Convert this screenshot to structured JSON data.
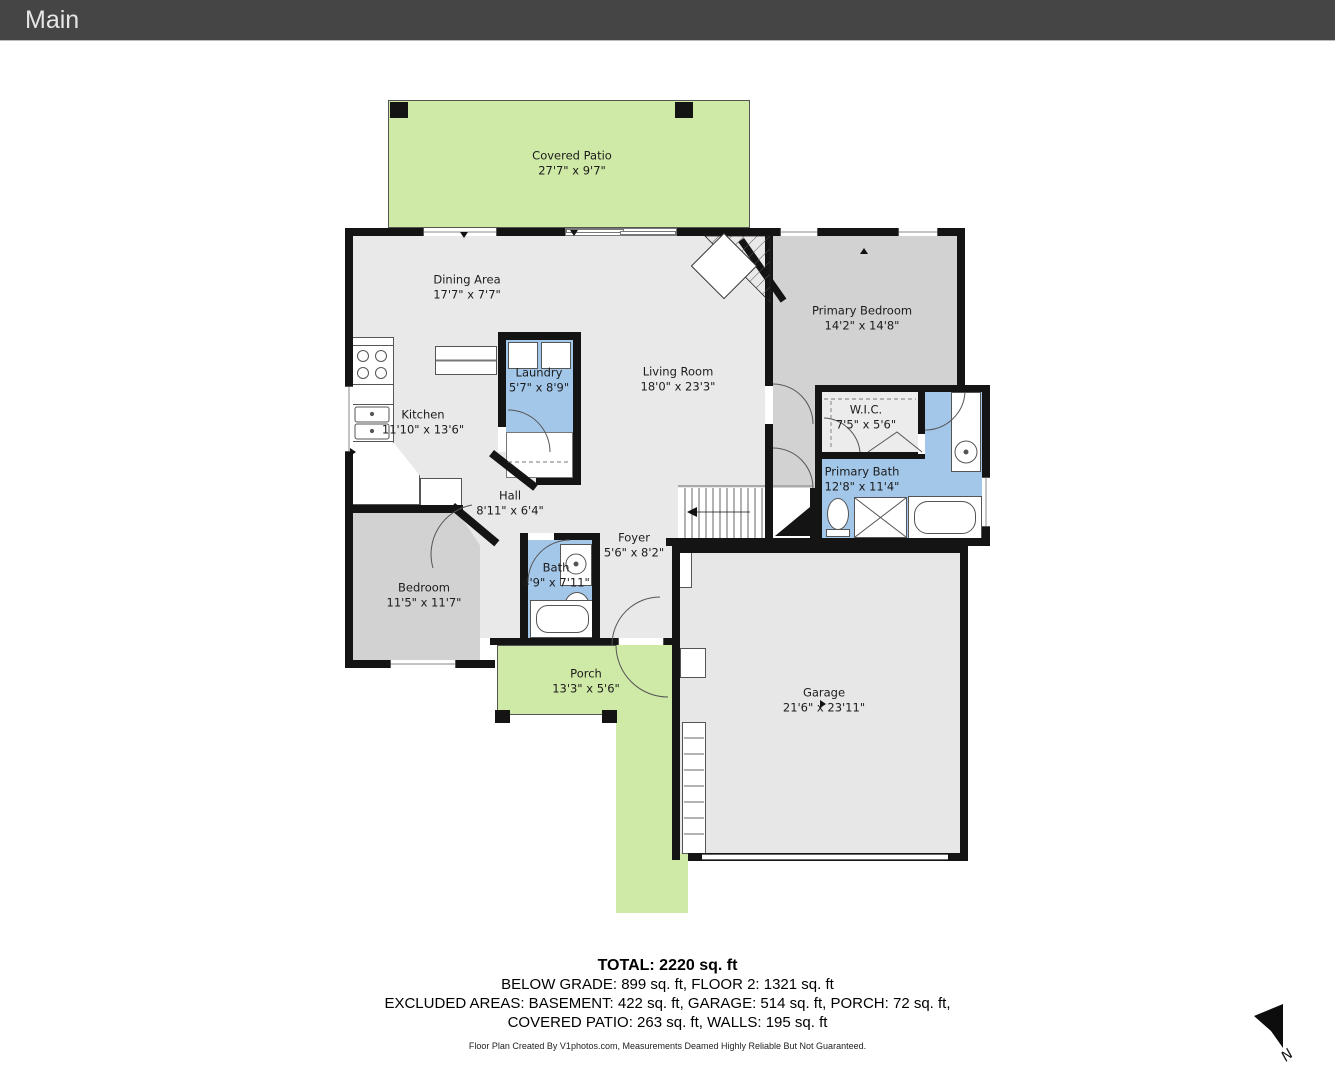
{
  "header": {
    "title": "Main"
  },
  "rooms": {
    "covered_patio": {
      "name": "Covered Patio",
      "dims": "27'7\" x 9'7\""
    },
    "dining": {
      "name": "Dining Area",
      "dims": "17'7\" x 7'7\""
    },
    "kitchen": {
      "name": "Kitchen",
      "dims": "11'10\" x 13'6\""
    },
    "laundry": {
      "name": "Laundry",
      "dims": "5'7\" x 8'9\""
    },
    "living": {
      "name": "Living Room",
      "dims": "18'0\" x 23'3\""
    },
    "primary_bedroom": {
      "name": "Primary Bedroom",
      "dims": "14'2\" x 14'8\""
    },
    "wic": {
      "name": "W.I.C.",
      "dims": "7'5\" x 5'6\""
    },
    "primary_bath": {
      "name": "Primary Bath",
      "dims": "12'8\" x 11'4\""
    },
    "hall": {
      "name": "Hall",
      "dims": "8'11\" x 6'4\""
    },
    "foyer": {
      "name": "Foyer",
      "dims": "5'6\" x 8'2\""
    },
    "bath": {
      "name": "Bath",
      "dims": "4'9\" x 7'11\""
    },
    "bedroom": {
      "name": "Bedroom",
      "dims": "11'5\" x 11'7\""
    },
    "porch": {
      "name": "Porch",
      "dims": "13'3\" x 5'6\""
    },
    "garage": {
      "name": "Garage",
      "dims": "21'6\" x 23'11\""
    }
  },
  "summary": {
    "total": "TOTAL: 2220 sq. ft",
    "line2": "BELOW GRADE: 899 sq. ft, FLOOR 2: 1321 sq. ft",
    "line3": "EXCLUDED AREAS: BASEMENT: 422 sq. ft, GARAGE: 514 sq. ft, PORCH: 72 sq. ft,",
    "line4": "COVERED PATIO: 263 sq. ft, WALLS: 195 sq. ft",
    "disclaimer": "Floor Plan Created By V1photos.com, Measurements Deamed Highly Reliable But Not Guaranteed."
  },
  "compass": {
    "label": "N"
  },
  "colors": {
    "wall": "#141414",
    "floor": "#e9e9e9",
    "bedroom_floor": "#d2d2d2",
    "bath_blue": "#a3c7e9",
    "outdoor_green": "#cfe9a6",
    "topbar": "#454545"
  }
}
